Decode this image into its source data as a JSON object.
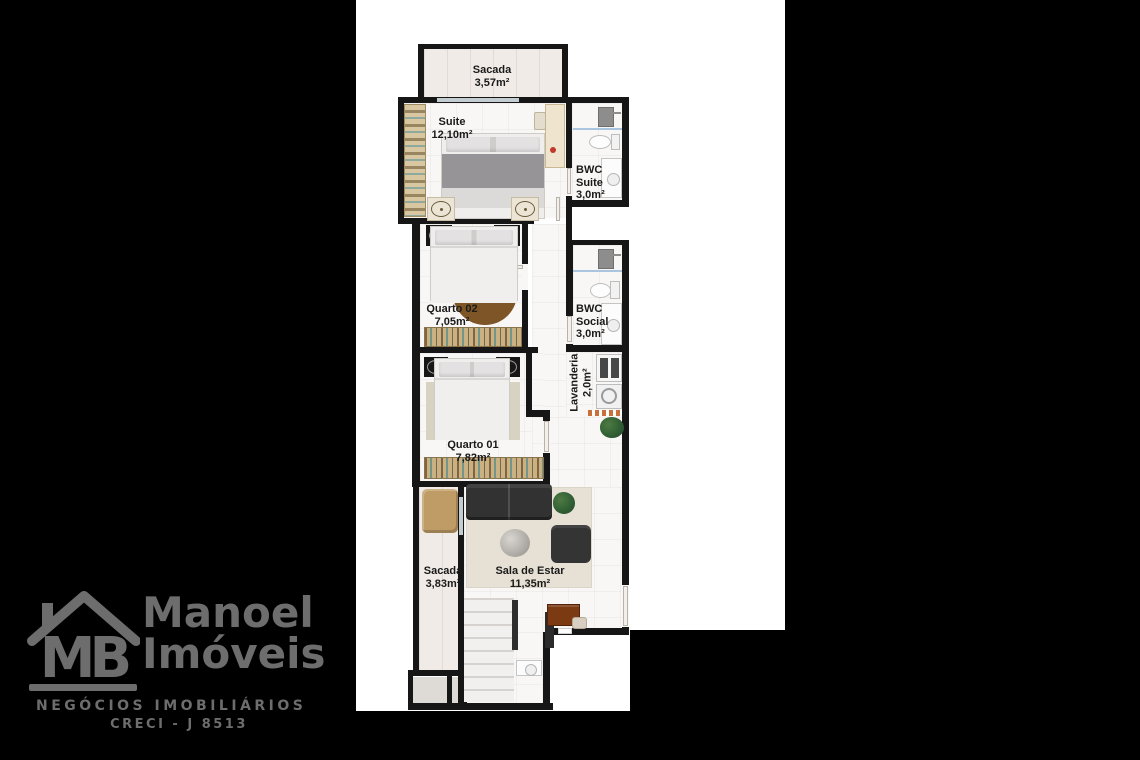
{
  "floorplan": {
    "backdrop_color": "#ffffff",
    "wall_color": "#161616",
    "background_color": "#000000",
    "rooms": [
      {
        "id": "sacada-top",
        "name": "Sacada",
        "area": "3,57m²"
      },
      {
        "id": "suite",
        "name": "Suite",
        "area": "12,10m²"
      },
      {
        "id": "bwc-suite",
        "name": "BWC Suite",
        "area": "3,0m²"
      },
      {
        "id": "quarto-02",
        "name": "Quarto 02",
        "area": "7,05m²"
      },
      {
        "id": "bwc-social",
        "name": "BWC Social",
        "area": "3,0m²"
      },
      {
        "id": "lavanderia",
        "name": "Lavanderia",
        "area": "2,0m²"
      },
      {
        "id": "quarto-01",
        "name": "Quarto 01",
        "area": "7,82m²"
      },
      {
        "id": "sacada-bottom",
        "name": "Sacada",
        "area": "3,83m²"
      },
      {
        "id": "sala-de-estar",
        "name": "Sala de Estar",
        "area": "11,35m²"
      }
    ]
  },
  "logo": {
    "monogram": "MB",
    "brand_line1": "Manoel",
    "brand_line2": "Imóveis",
    "tagline": "NEGÓCIOS IMOBILIÁRIOS",
    "creci": "CRECI - J 8513",
    "color": "#6d6d6d"
  }
}
